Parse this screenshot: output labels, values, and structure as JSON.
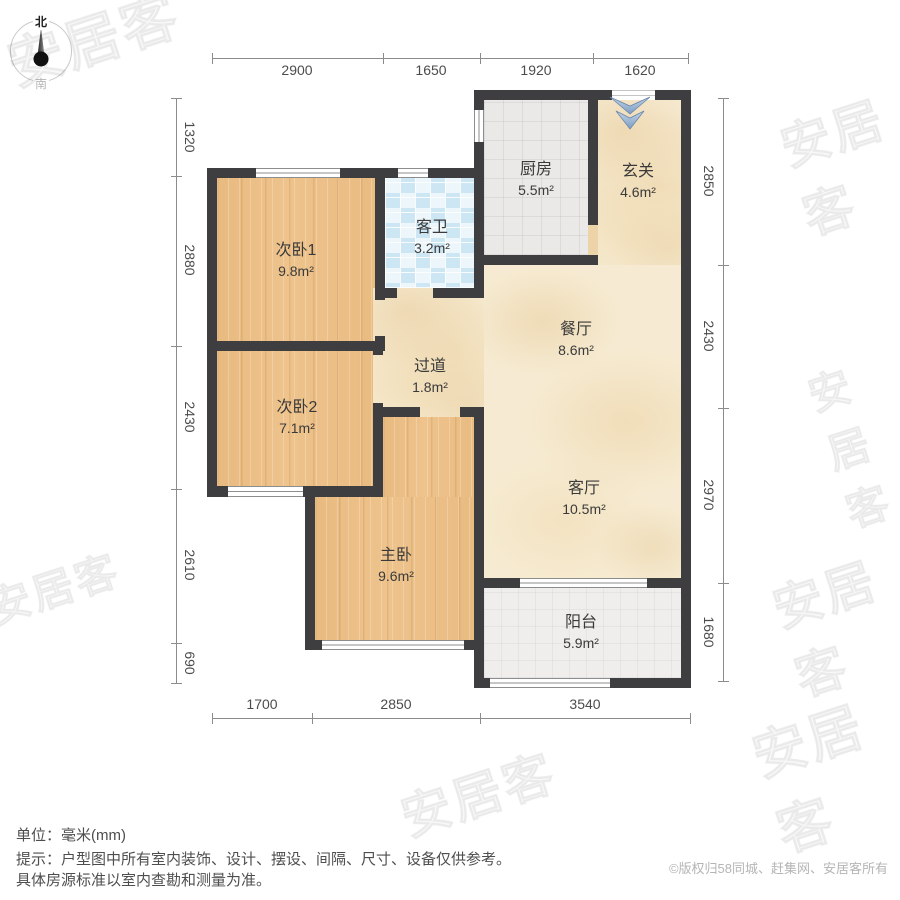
{
  "compass": {
    "north": "北",
    "south": "南"
  },
  "dims": {
    "top": [
      "2900",
      "1650",
      "1920",
      "1620"
    ],
    "bottom": [
      "1700",
      "2850",
      "3540"
    ],
    "left": [
      "1320",
      "2880",
      "2430",
      "2610",
      "690"
    ],
    "right": [
      "2850",
      "2430",
      "2970",
      "1680"
    ]
  },
  "rooms": {
    "ciwo1": {
      "name": "次卧1",
      "area": "9.8m²"
    },
    "kewei": {
      "name": "客卫",
      "area": "3.2m²"
    },
    "chufang": {
      "name": "厨房",
      "area": "5.5m²"
    },
    "xuanguan": {
      "name": "玄关",
      "area": "4.6m²"
    },
    "canting": {
      "name": "餐厅",
      "area": "8.6m²"
    },
    "guodao": {
      "name": "过道",
      "area": "1.8m²"
    },
    "ciwo2": {
      "name": "次卧2",
      "area": "7.1m²"
    },
    "keting": {
      "name": "客厅",
      "area": "10.5m²"
    },
    "zhuwo": {
      "name": "主卧",
      "area": "9.6m²"
    },
    "yangtai": {
      "name": "阳台",
      "area": "5.9m²"
    }
  },
  "footer": {
    "unit": "单位：毫米(mm)",
    "tip_line1": "提示：户型图中所有室内装饰、设计、摆设、间隔、尺寸、设备仅供参考。",
    "tip_line2": "具体房源标准以室内查勘和测量为准。",
    "copyright": "©版权归58同城、赶集网、安居客所有"
  },
  "watermark": {
    "text": "安居客"
  },
  "colors": {
    "wall": "#3e3e40",
    "wood_floor": "#eec38c",
    "marble_floor": "#f6ebd2",
    "bath_tile": "#cde6f4",
    "kitchen_tile": "#eae9e7",
    "balcony_tile": "#efeeec",
    "entry_arrow": "#8fa9c9",
    "dim_text": "#4c4c4c",
    "copyright_text": "#b5b5b5"
  }
}
